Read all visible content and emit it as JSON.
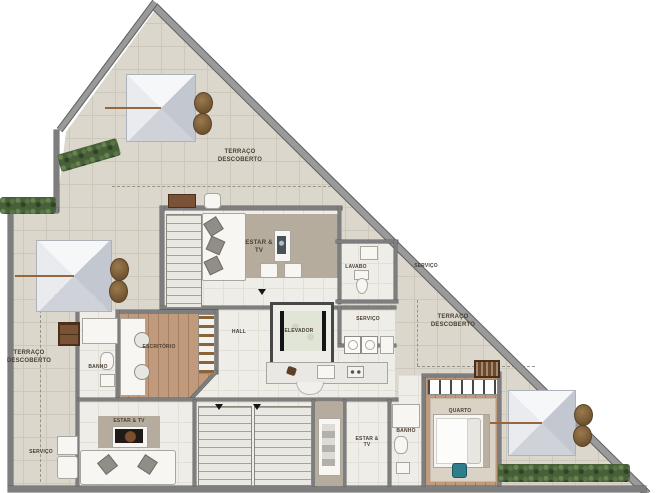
{
  "meta": {
    "type": "architectural floor plan",
    "language": "pt-BR",
    "description": "Upper floor plan of a triangular penthouse with terraces, skylights, elevator and stairs"
  },
  "rooms": {
    "terraco_top": "TERRAÇO DESCOBERTO",
    "terraco_left": "TERRAÇO DESCOBERTO",
    "terraco_right": "TERRAÇO DESCOBERTO",
    "estar_tv_upper": "ESTAR & TV",
    "estar_tv_lower": "ESTAR & TV",
    "estar_tv_small": "ESTAR & TV",
    "lavabo": "LAVABO",
    "servico_right": "SERVIÇO",
    "servico_mid": "SERVIÇO",
    "servico_left": "SERVIÇO",
    "hall": "HALL",
    "elevador": "ELEVADOR",
    "banho_upper": "BANHO",
    "banho_lower": "BANHO",
    "escritorio": "ESCRITÓRIO",
    "quarto": "QUARTO"
  },
  "colors": {
    "terrace_tile": "#dbd7cc",
    "interior_floor": "#efede8",
    "wood_floor": "#c19a7c",
    "accent_taupe": "#b5ac9d",
    "wall": "#7e7e7e",
    "hedge_green": "#47603a",
    "skylight_gray": "#d9dce2",
    "label_text": "#4a3f33",
    "accent_blue_item": "#2e7d8c"
  }
}
